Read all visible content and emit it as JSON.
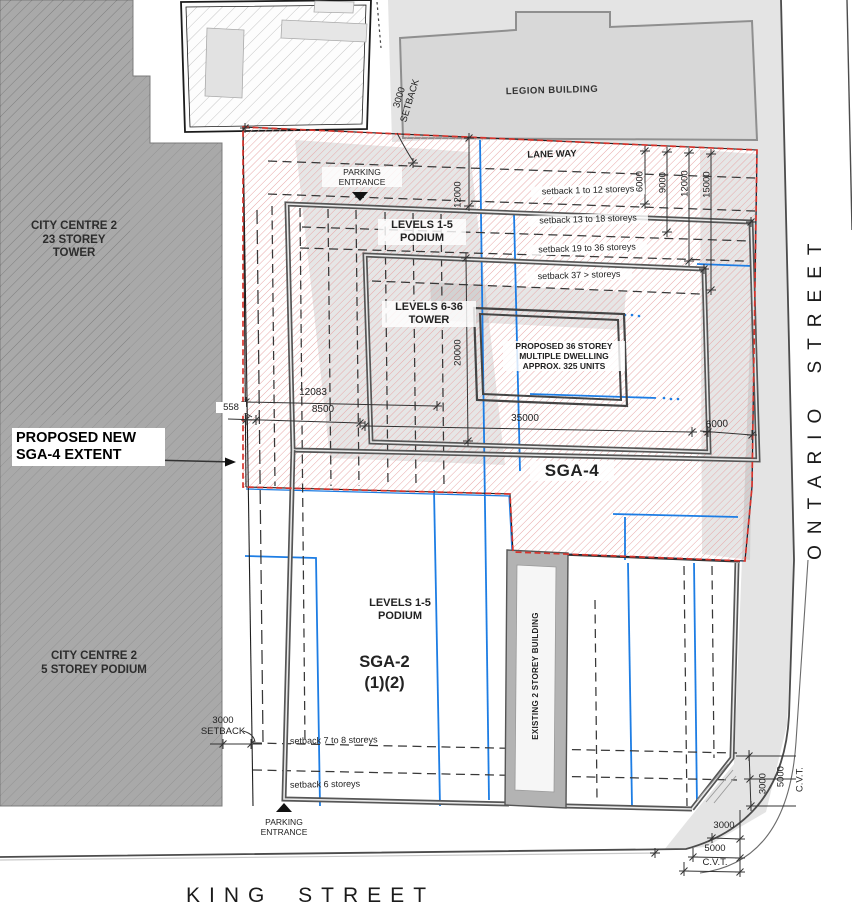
{
  "colors": {
    "red_boundary": "#d8342c",
    "red_hatch": "#e8a8a8",
    "blue_line": "#1d7de4",
    "building_gray": "#a9a9a9",
    "legion_gray": "#d8d8d8",
    "line_dark": "#3a3a3a"
  },
  "streets": {
    "king": "KING STREET",
    "ontario": "ONTARIO STREET"
  },
  "areas": {
    "sga4": "SGA-4",
    "sga2": "SGA-2\n(1)(2)",
    "proposed_new_extent": "PROPOSED NEW\nSGA-4 EXTENT"
  },
  "buildings": {
    "legion": "LEGION BUILDING",
    "city_centre_tower": "CITY CENTRE 2\n23 STOREY\nTOWER",
    "city_centre_podium": "CITY CENTRE 2\n5 STOREY PODIUM",
    "existing": "EXISTING 2 STOREY BUILDING",
    "proposed": "PROPOSED 36 STOREY\nMULTIPLE DWELLING\nAPPROX. 325 UNITS",
    "levels_podium_upper": "LEVELS 1-5\nPODIUM",
    "levels_podium_lower": "LEVELS 1-5\nPODIUM",
    "levels_tower": "LEVELS 6-36\nTOWER"
  },
  "annotations": {
    "lane_way": "LANE WAY",
    "parking_entrance_top": "PARKING\nENTRANCE",
    "parking_entrance_bottom": "PARKING\nENTRANCE",
    "setback_1_12": "setback 1 to 12 storeys",
    "setback_13_18": "setback 13 to 18 storeys",
    "setback_19_36": "setback 19 to 36 storeys",
    "setback_37": "setback 37 > storeys",
    "setback_7_8": "setback 7 to 8 storeys",
    "setback_6": "setback 6 storeys",
    "setback_3000_top": "3000\nSETBACK",
    "setback_3000_left": "3000\nSETBACK"
  },
  "dimensions": {
    "d12000_left": "12000",
    "d6000_lane": "6000",
    "d9000_lane": "9000",
    "d12000_lane": "12000",
    "d15000_lane": "15000",
    "d20000": "20000",
    "d35000": "35000",
    "d6000_east": "6000",
    "d12083": "12083",
    "d8500": "8500",
    "d558": "558",
    "d3000_v": "3000",
    "d5000_v": "5000",
    "cvt_v": "C.V.T.",
    "d3000_h": "3000",
    "d5000_h": "5000",
    "cvt_h": "C.V.T."
  }
}
